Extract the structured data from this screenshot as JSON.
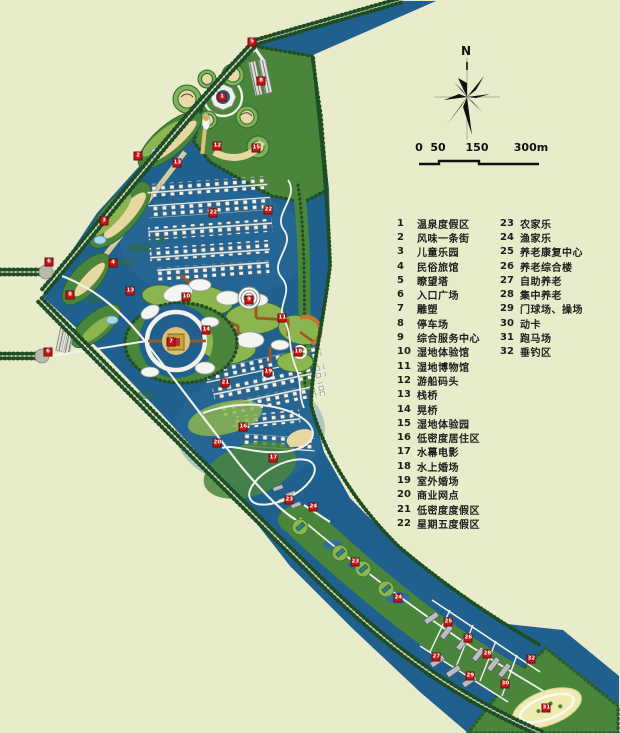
{
  "title": "wetland resort master plan",
  "colors": {
    "background": "#e9ecca",
    "water": "#20608f",
    "water_light": "#2d6f9e",
    "green": "#4a853c",
    "green_light": "#8cb44f",
    "tree": "#1d4d22",
    "sand": "#e6d8a0",
    "road": "#f2f2ea",
    "bridge": "#9c5a22",
    "marker_red": "#c81616"
  },
  "north": {
    "label": "N"
  },
  "scale_bar": {
    "labels": [
      {
        "text": "0",
        "x": 12
      },
      {
        "text": "50",
        "x": 31
      },
      {
        "text": "150",
        "x": 70
      },
      {
        "text": "300m",
        "x": 124
      }
    ]
  },
  "legend": {
    "left": [
      {
        "num": "1",
        "label": "温泉度假区"
      },
      {
        "num": "2",
        "label": "风味一条街"
      },
      {
        "num": "3",
        "label": "儿童乐园"
      },
      {
        "num": "4",
        "label": "民俗旅馆"
      },
      {
        "num": "5",
        "label": "瞭望塔"
      },
      {
        "num": "6",
        "label": "入口广场"
      },
      {
        "num": "7",
        "label": "雕塑"
      },
      {
        "num": "8",
        "label": "停车场"
      },
      {
        "num": "9",
        "label": "综合服务中心"
      },
      {
        "num": "10",
        "label": "湿地体验馆"
      },
      {
        "num": "11",
        "label": "湿地博物馆"
      },
      {
        "num": "12",
        "label": "游船码头"
      },
      {
        "num": "13",
        "label": "栈桥"
      },
      {
        "num": "14",
        "label": "晃桥"
      },
      {
        "num": "15",
        "label": "湿地体验园"
      },
      {
        "num": "16",
        "label": "低密度居住区"
      },
      {
        "num": "17",
        "label": "水幕电影"
      },
      {
        "num": "18",
        "label": "水上婚场"
      },
      {
        "num": "19",
        "label": "室外婚场"
      },
      {
        "num": "20",
        "label": "商业网点"
      },
      {
        "num": "21",
        "label": "低密度度假区"
      },
      {
        "num": "22",
        "label": "星期五度假区"
      }
    ],
    "right": [
      {
        "num": "23",
        "label": "农家乐"
      },
      {
        "num": "24",
        "label": "渔家乐"
      },
      {
        "num": "25",
        "label": "养老康复中心"
      },
      {
        "num": "26",
        "label": "养老综合楼"
      },
      {
        "num": "27",
        "label": "自助养老"
      },
      {
        "num": "28",
        "label": "集中养老"
      },
      {
        "num": "29",
        "label": "门球场、操场"
      },
      {
        "num": "30",
        "label": "动卡"
      },
      {
        "num": "31",
        "label": "跑马场"
      },
      {
        "num": "32",
        "label": "垂钓区"
      }
    ]
  },
  "markers": [
    {
      "n": "1",
      "x": 222,
      "y": 97
    },
    {
      "n": "2",
      "x": 138,
      "y": 156
    },
    {
      "n": "3",
      "x": 104,
      "y": 221
    },
    {
      "n": "4",
      "x": 113,
      "y": 263
    },
    {
      "n": "5",
      "x": 252,
      "y": 42
    },
    {
      "n": "6",
      "x": 49,
      "y": 262
    },
    {
      "n": "6",
      "x": 48,
      "y": 352
    },
    {
      "n": "7",
      "x": 171,
      "y": 342
    },
    {
      "n": "8",
      "x": 261,
      "y": 81
    },
    {
      "n": "8",
      "x": 70,
      "y": 295
    },
    {
      "n": "9",
      "x": 249,
      "y": 300
    },
    {
      "n": "10",
      "x": 186,
      "y": 297
    },
    {
      "n": "11",
      "x": 282,
      "y": 318
    },
    {
      "n": "12",
      "x": 217,
      "y": 146
    },
    {
      "n": "13",
      "x": 177,
      "y": 163
    },
    {
      "n": "13",
      "x": 130,
      "y": 291
    },
    {
      "n": "14",
      "x": 206,
      "y": 330
    },
    {
      "n": "15",
      "x": 256,
      "y": 148
    },
    {
      "n": "16",
      "x": 243,
      "y": 427
    },
    {
      "n": "17",
      "x": 273,
      "y": 458
    },
    {
      "n": "18",
      "x": 298,
      "y": 352
    },
    {
      "n": "19",
      "x": 268,
      "y": 372
    },
    {
      "n": "20",
      "x": 217,
      "y": 443
    },
    {
      "n": "21",
      "x": 225,
      "y": 383
    },
    {
      "n": "22",
      "x": 213,
      "y": 213
    },
    {
      "n": "22",
      "x": 268,
      "y": 210
    },
    {
      "n": "23",
      "x": 289,
      "y": 500
    },
    {
      "n": "23",
      "x": 355,
      "y": 562
    },
    {
      "n": "24",
      "x": 313,
      "y": 507
    },
    {
      "n": "24",
      "x": 398,
      "y": 598
    },
    {
      "n": "25",
      "x": 448,
      "y": 622
    },
    {
      "n": "26",
      "x": 468,
      "y": 638
    },
    {
      "n": "27",
      "x": 436,
      "y": 657
    },
    {
      "n": "28",
      "x": 487,
      "y": 654
    },
    {
      "n": "29",
      "x": 470,
      "y": 676
    },
    {
      "n": "30",
      "x": 505,
      "y": 684
    },
    {
      "n": "31",
      "x": 546,
      "y": 708
    },
    {
      "n": "32",
      "x": 531,
      "y": 659
    }
  ]
}
